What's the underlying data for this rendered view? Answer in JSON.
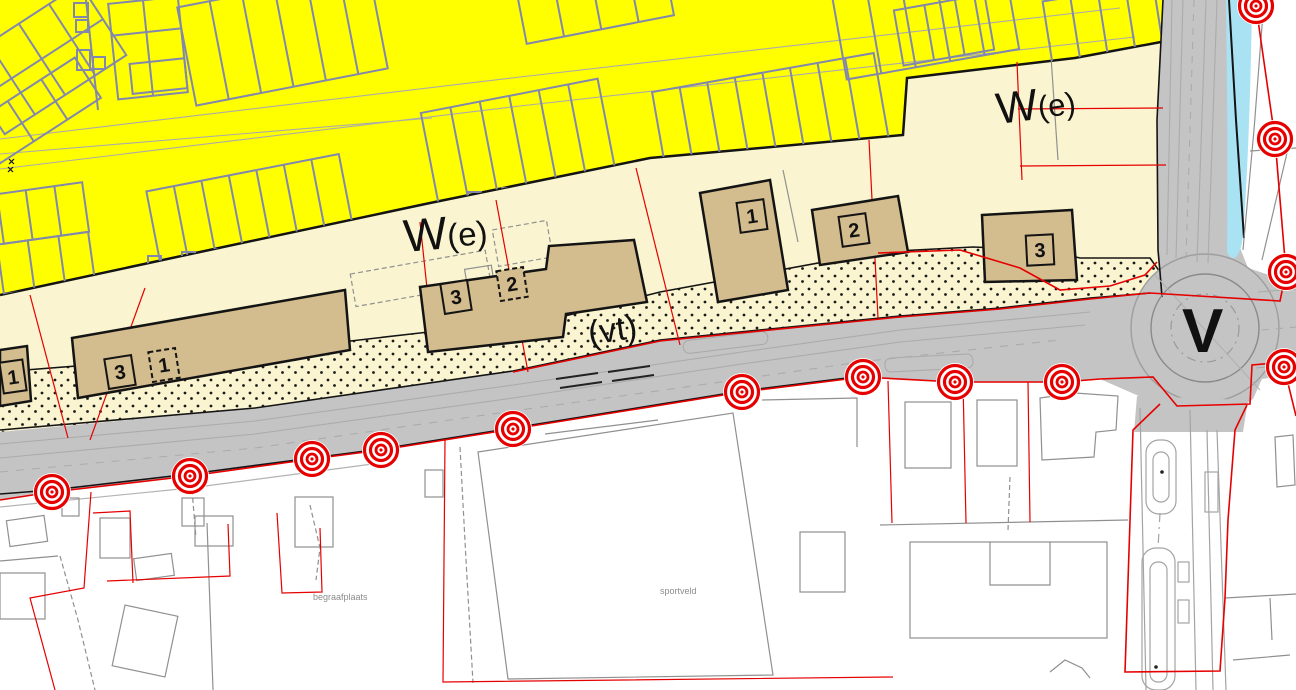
{
  "map": {
    "zone_labels": {
      "we_left": {
        "main": "W",
        "sub": "(e)"
      },
      "we_right": {
        "main": "W",
        "sub": "(e)"
      },
      "vt": "(vt)",
      "v": "V"
    },
    "area_labels": {
      "cemetery": "begraafplaats",
      "sports_field": "sportveld"
    },
    "building_numbers": {
      "far_left": "1",
      "left_a": "3",
      "left_b": "1",
      "mid_a": "3",
      "mid_b": "2",
      "east_1": "1",
      "east_2": "2",
      "east_3": "3"
    },
    "colors": {
      "residential_yellow": "#FFFF00",
      "mixed_cream": "#FAF5D0",
      "building_tan": "#D3BC8D",
      "road_gray": "#C4C4C4",
      "water_cyan": "#A9E2F3",
      "boundary_red": "#E60000",
      "cadastral_slate": "#8287AD",
      "parcel_gray": "#909090"
    }
  }
}
